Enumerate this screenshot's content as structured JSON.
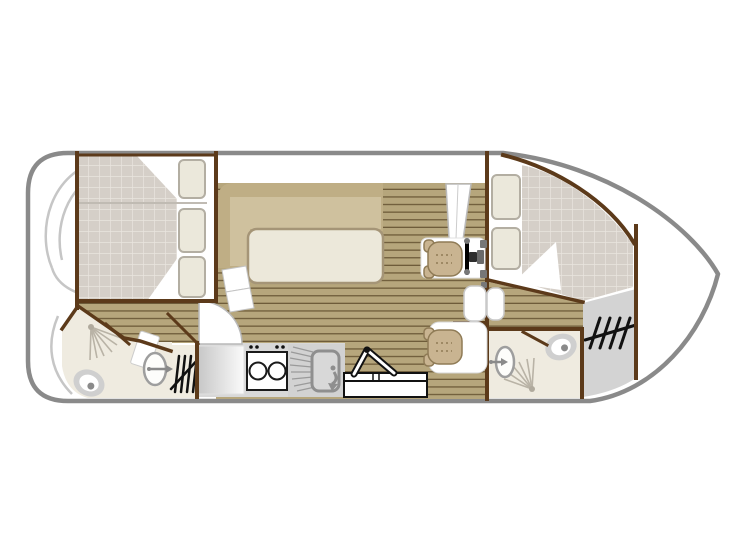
{
  "figure": {
    "type": "boat-floor-plan",
    "orientation": "bow-right"
  },
  "colors": {
    "hull_outline": "#8a8a8a",
    "interior_wall": "#5c3a1a",
    "wood_floor": "#b6a67c",
    "wood_plank_line": "#6e5c39",
    "mattress": "#d5cfc8",
    "mattress_grid": "#e9e5df",
    "pillow": "#ebe8db",
    "pillow_edge": "#b3aea2",
    "sofa_back": "#bfae85",
    "sofa_seat": "#cfc19e",
    "table_top": "#ece8da",
    "bathroom_floor": "#efebe0",
    "counter_gray": "#d8d8d8",
    "locker_gray": "#d3d3d3",
    "fixture_gray": "#9e9e9e",
    "icon_black": "#111111"
  },
  "rooms": {
    "stern_deck": "stern deck",
    "aft_cabin": "aft cabin with double and single berth",
    "aft_bathroom": "aft bathroom with shower and toilet",
    "washbasin_nook": "washbasin nook with companion steps",
    "saloon": "saloon with L-sofa and table",
    "galley": "galley with fridge, stove and sink",
    "helm": "inner helm station with steering wheel",
    "bow_cabin": "bow cabin with double berth",
    "bow_bathroom": "bow bathroom with shower, washbasin and toilet",
    "bow_locker": "bow locker with deck steps",
    "bow_deck": "bow deck"
  },
  "icons": {
    "steps": "companionway-steps-icon",
    "shower": "shower-spray-icon",
    "toilet": "toilet-icon",
    "washbasin": "washbasin-icon",
    "stove": "two-burner-stove-icon",
    "sink": "sink-with-drainer-icon",
    "folding_table": "folding-table-icon",
    "wheel": "steering-wheel-icon"
  }
}
